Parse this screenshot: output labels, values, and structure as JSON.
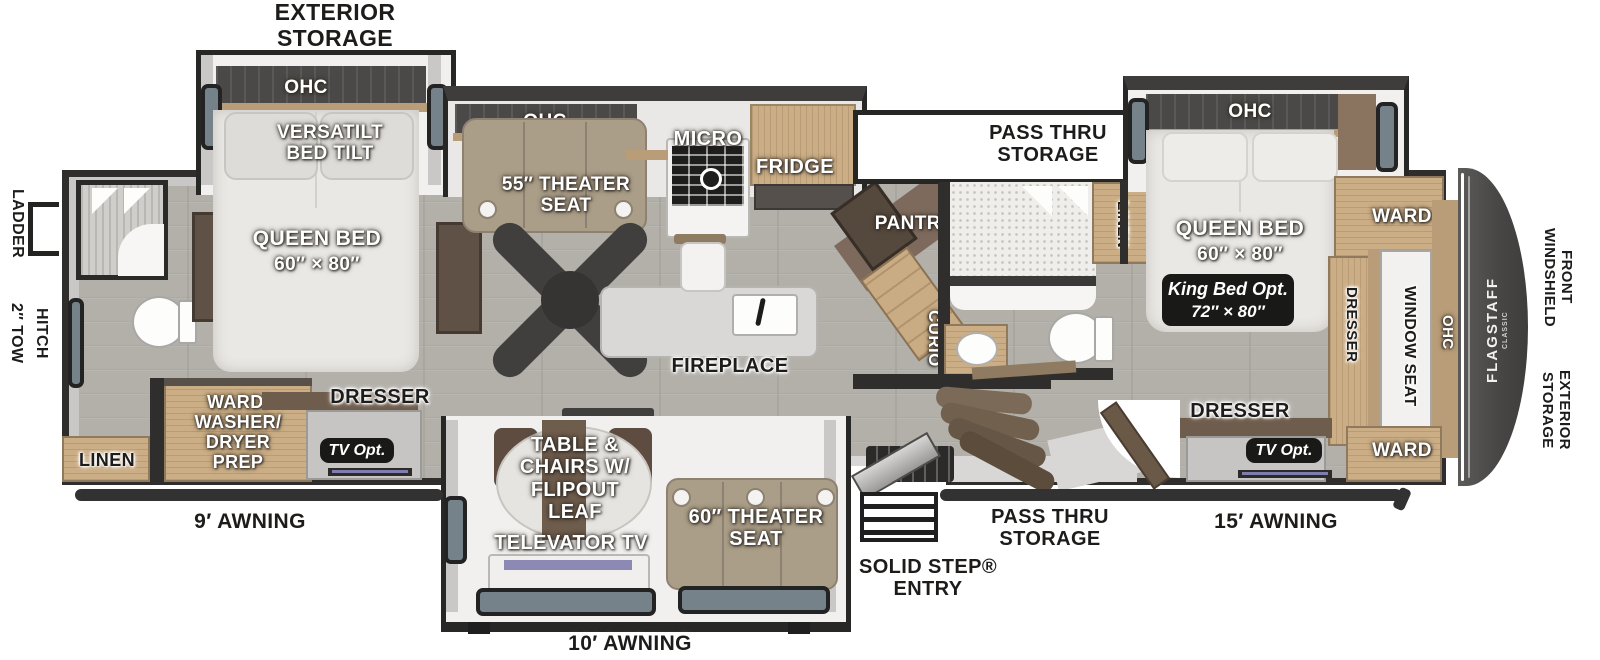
{
  "exterior": {
    "storage_top": [
      "EXTERIOR",
      "STORAGE"
    ],
    "ladder": "LADDER",
    "tow_hitch": [
      "2″ TOW",
      "HITCH"
    ],
    "front_windshield": [
      "FRONT",
      "WINDSHIELD"
    ],
    "storage_right": [
      "EXTERIOR",
      "STORAGE"
    ],
    "awning_9": "9′ AWNING",
    "awning_10": "10′ AWNING",
    "awning_15": "15′ AWNING",
    "solid_step": [
      "SOLID STEP®",
      "ENTRY"
    ],
    "pass_thru_bottom": [
      "PASS THRU",
      "STORAGE"
    ],
    "brand": "FLAGSTAFF",
    "brand_sub": "CLASSIC"
  },
  "storage_top": [
    "PASS THRU",
    "STORAGE"
  ],
  "rear_bedroom": {
    "ohc": "OHC",
    "versatilt": [
      "VERSATILT",
      "BED TILT"
    ],
    "bed": "QUEEN BED",
    "bed_size": "60″ × 80″",
    "dresser": "DRESSER",
    "tv_opt": "TV Opt.",
    "ward_washer": [
      "WARD/",
      "WASHER/",
      "DRYER",
      "PREP"
    ],
    "linen": "LINEN"
  },
  "kitchen": {
    "ohc": "OHC",
    "theater": [
      "55″ THEATER",
      "SEAT"
    ],
    "micro": "MICRO",
    "fridge": "FRIDGE",
    "pantry": "PANTRY",
    "curio": "CURIO",
    "fireplace": "FIREPLACE"
  },
  "mid_bath": {
    "linen": "LINEN"
  },
  "front_bedroom": {
    "ohc": "OHC",
    "bed": "QUEEN BED",
    "bed_size": "60″ × 80″",
    "king_opt": [
      "King Bed Opt.",
      "72″ × 80″"
    ],
    "ward_top": "WARD",
    "ward_bottom": "WARD",
    "window_seat": "WINDOW SEAT",
    "dresser_side": "DRESSER",
    "dresser": "DRESSER",
    "tv_opt": "TV Opt.",
    "ohc_side": "OHC"
  },
  "garage": {
    "table": [
      "TABLE &",
      "CHAIRS W/",
      "FLIPOUT",
      "LEAF"
    ],
    "televator": "TELEVATOR TV",
    "theater": [
      "60″ THEATER",
      "SEAT"
    ]
  }
}
